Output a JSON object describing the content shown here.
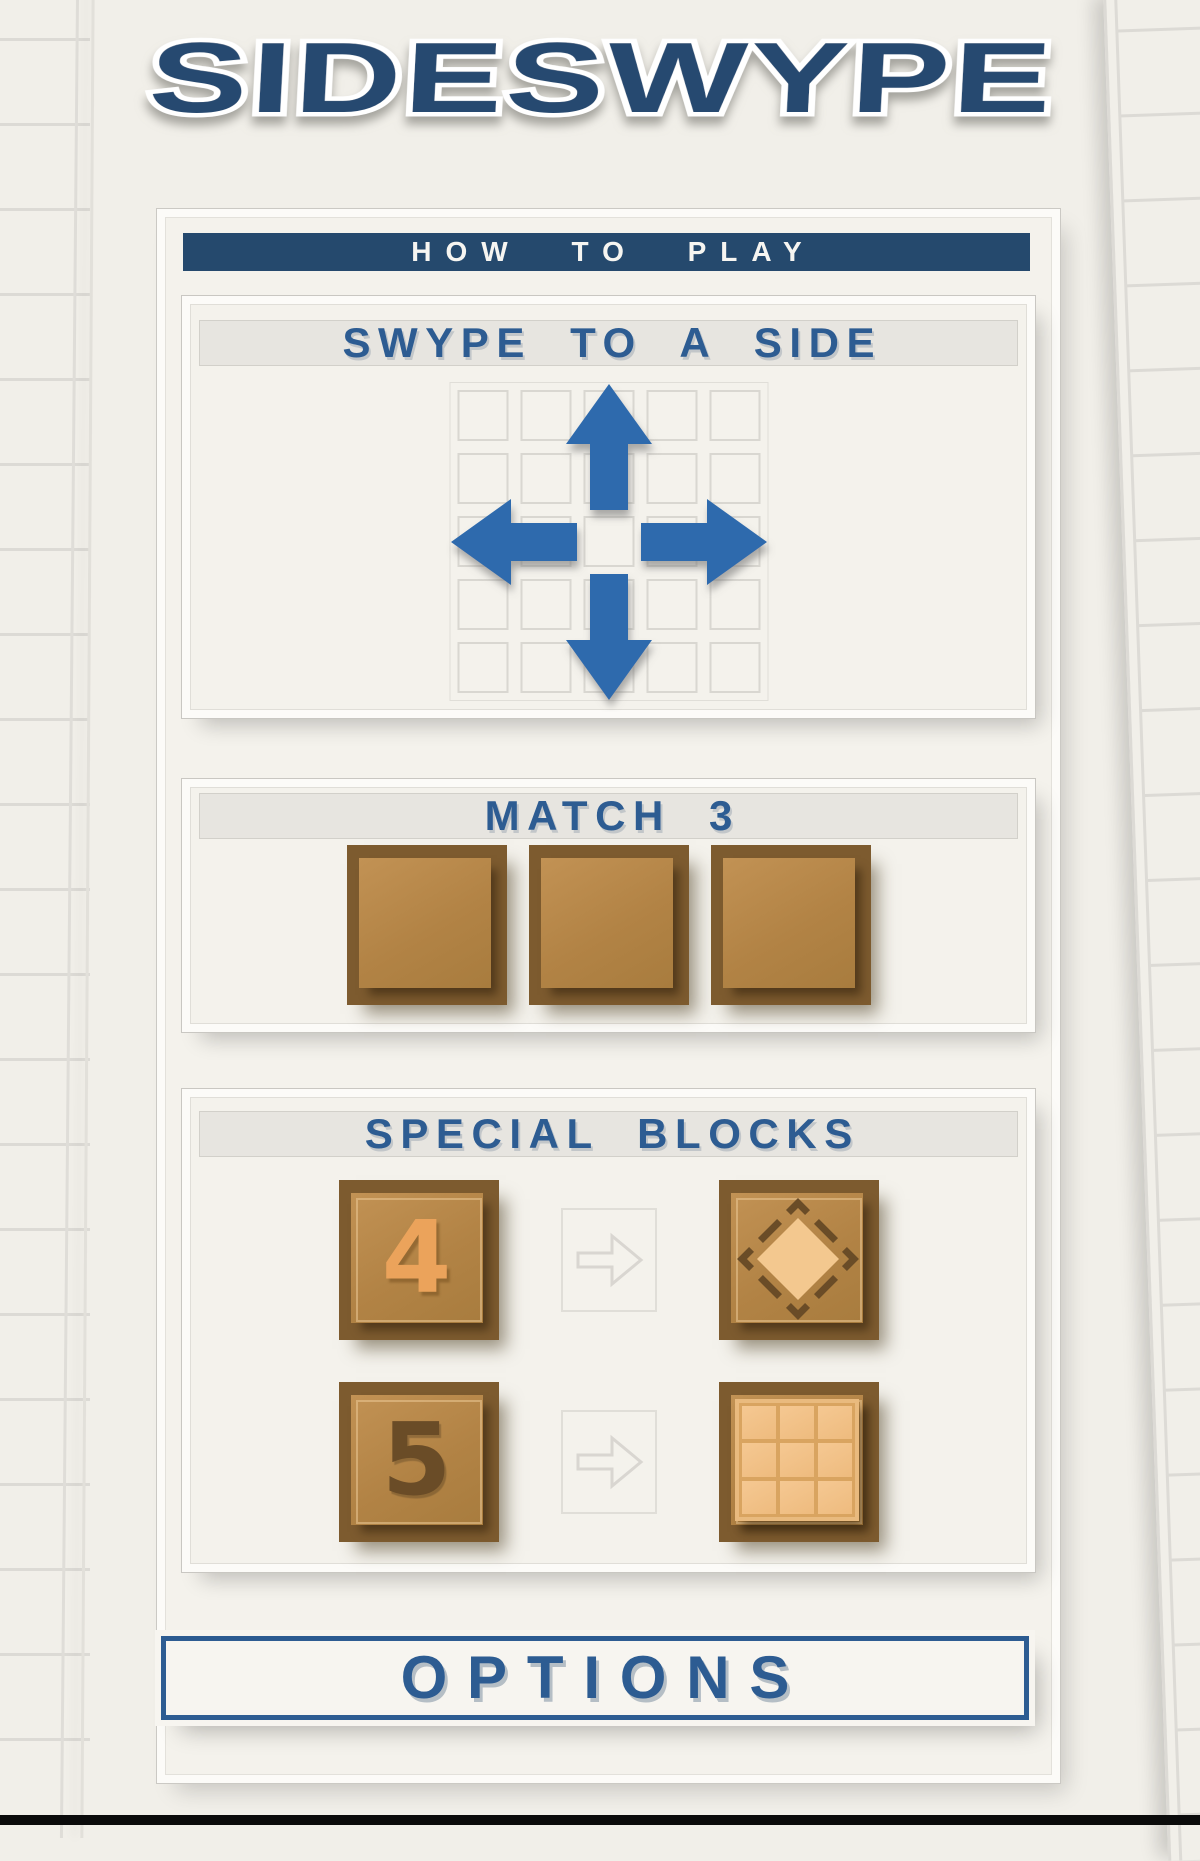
{
  "title": "SIDESWYPE",
  "how_to_play": {
    "label": "HOW TO PLAY"
  },
  "sections": {
    "swype": {
      "heading": "SWYPE TO A SIDE",
      "icon": "swipe-arrows-icon",
      "grid": {
        "rows": 5,
        "cols": 5,
        "cells": 25
      }
    },
    "match": {
      "heading": "MATCH 3",
      "block_count": 3
    },
    "special": {
      "heading": "SPECIAL BLOCKS",
      "rows": [
        {
          "source_digit": "4",
          "arrow_icon": "arrow-right-icon",
          "result_icon": "diamond-block-icon"
        },
        {
          "source_digit": "5",
          "arrow_icon": "arrow-right-icon",
          "result_icon": "grid-block-icon"
        }
      ]
    }
  },
  "options": {
    "label": "OPTIONS"
  },
  "colors": {
    "navy": "#25496d",
    "headingBlue": "#2d5c92",
    "arrowBlue": "#2f6bad",
    "titleBlue": "#27496f",
    "pageBg": "#f4f2ec",
    "paperBg": "#f1efe9",
    "lineGray": "#dcdad5",
    "headerBar": "#e7e5e0",
    "blockDark": "#7d5b2f",
    "blockMid": "#b28345",
    "digitOrange": "#eba35b",
    "digitDark": "#6a4c27",
    "diamondFill": "#f3c88f",
    "grayArrow": "#d9d6d1",
    "bottomBar": "#0b0b0b"
  }
}
